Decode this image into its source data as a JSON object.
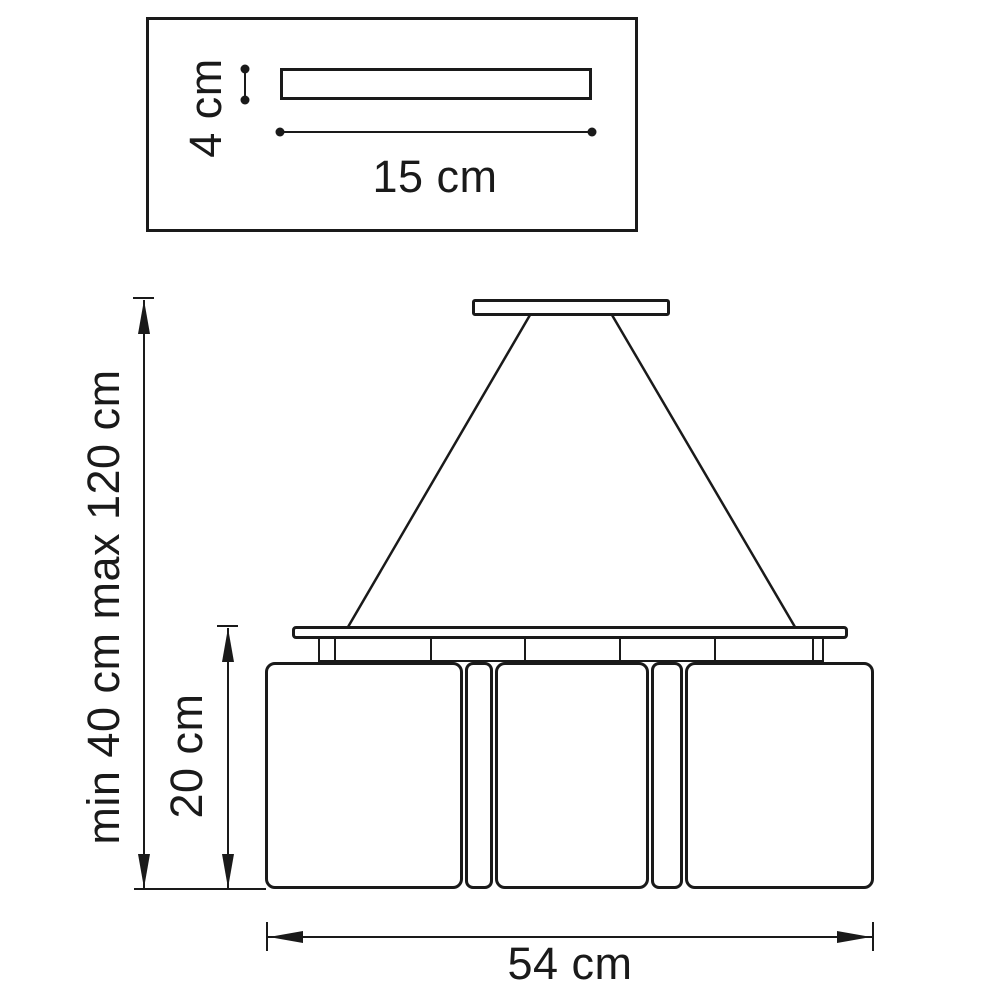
{
  "drawing": {
    "canopy_detail": {
      "height_label": "4 cm",
      "width_label": "15 cm"
    },
    "pendant": {
      "suspension_range_label": "min 40 cm max 120 cm",
      "shade_height_label": "20 cm",
      "overall_width_label": "54 cm"
    }
  },
  "colors": {
    "line": "#1a1a1a",
    "background": "#ffffff"
  }
}
